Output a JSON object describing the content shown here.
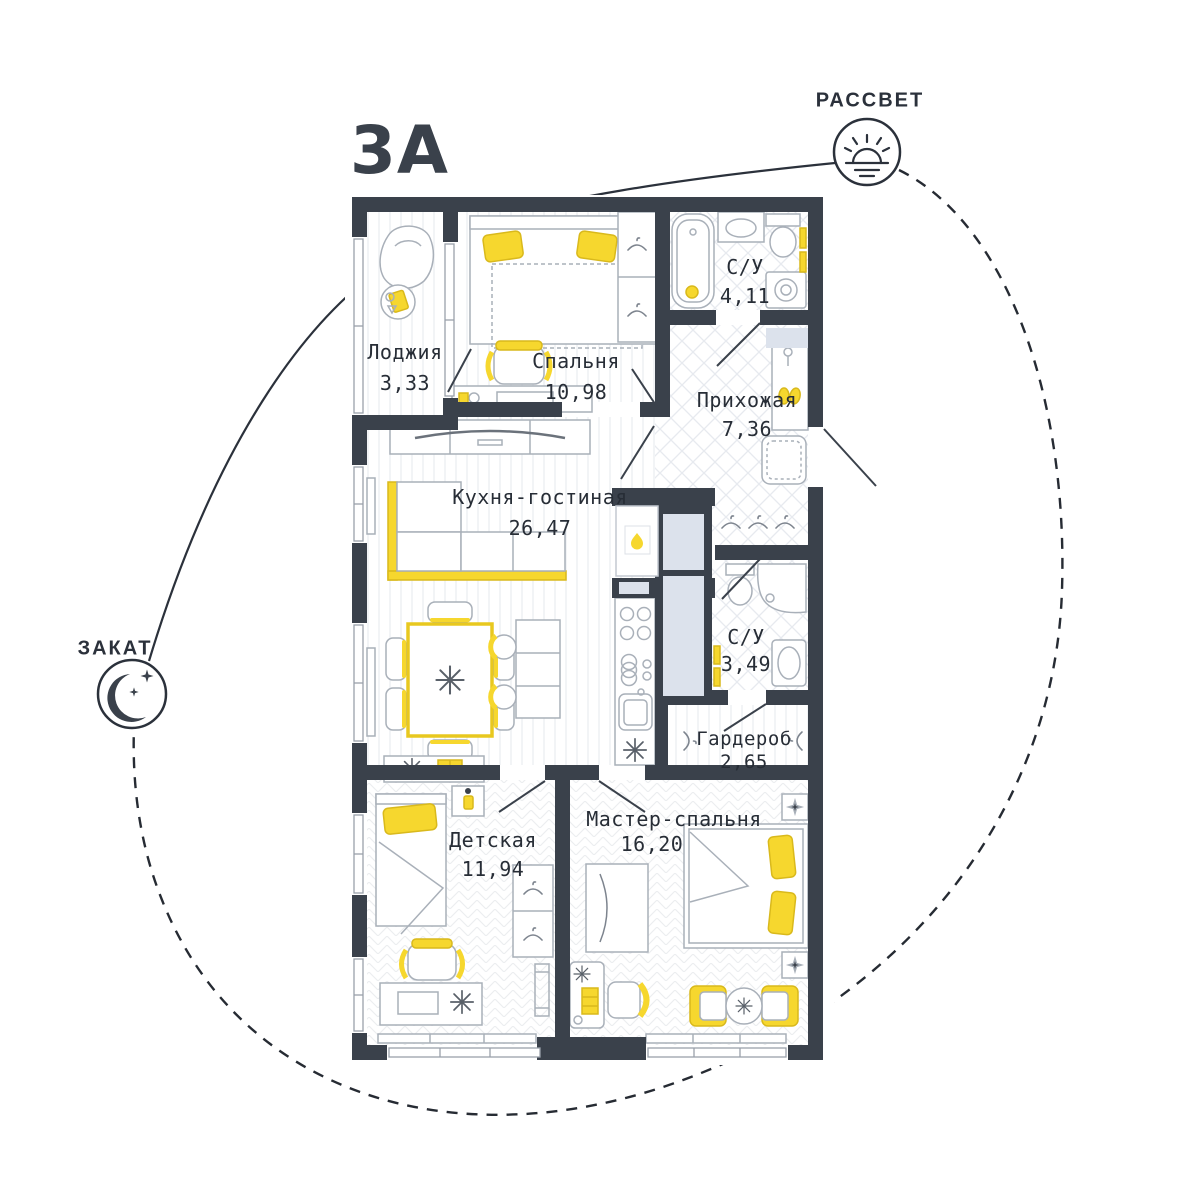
{
  "title": "3А",
  "compass": {
    "sunrise_label": "РАССВЕТ",
    "sunset_label": "ЗАКАТ"
  },
  "rooms": [
    {
      "id": "loggia",
      "name": "Лоджия",
      "area": "3,33"
    },
    {
      "id": "bedroom",
      "name": "Спальня",
      "area": "10,98"
    },
    {
      "id": "bathroom-1",
      "name": "С/У",
      "area": "4,11"
    },
    {
      "id": "hallway",
      "name": "Прихожая",
      "area": "7,36"
    },
    {
      "id": "kitchen-living",
      "name": "Кухня-гостиная",
      "area": "26,47"
    },
    {
      "id": "bathroom-2",
      "name": "С/У",
      "area": "3,49"
    },
    {
      "id": "wardrobe",
      "name": "Гардероб",
      "area": "2,65"
    },
    {
      "id": "kids-room",
      "name": "Детская",
      "area": "11,94"
    },
    {
      "id": "master-bedroom",
      "name": "Мастер-спальня",
      "area": "16,20"
    }
  ],
  "icons": {
    "sunrise": "sun-over-horizon",
    "sunset": "crescent-moon-with-stars",
    "boiler": "flame",
    "fridge": "snowflake",
    "closet": "hanger"
  },
  "colors": {
    "wall": "#3a414b",
    "accent_yellow": "#f6d72e",
    "vent_shaft": "#dce2ec",
    "text": "#272d36",
    "furniture_line": "#a9b0b9"
  }
}
